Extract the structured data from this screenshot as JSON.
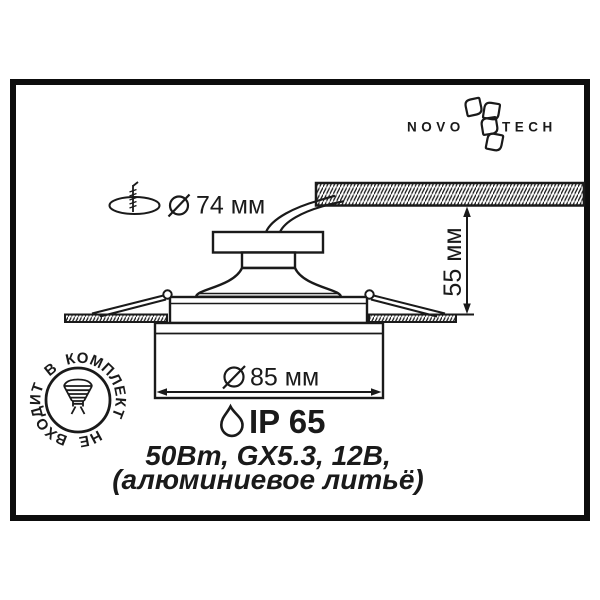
{
  "colors": {
    "ink": "#1a1a1a",
    "background": "#ffffff"
  },
  "brand": {
    "name_left": "NOVO",
    "name_right": "TECH",
    "flower_icon": "novotech-flower-icon"
  },
  "dimensions": {
    "cutout_diameter": {
      "icon": "screw-cutout-icon",
      "symbol": "diameter-symbol",
      "value": "74 мм"
    },
    "recess_depth": {
      "value": "55 мм"
    },
    "visible_diameter": {
      "symbol": "diameter-symbol",
      "value": "85 мм"
    }
  },
  "specs": {
    "ip_rating": {
      "icon": "water-drop-icon",
      "value": "IP 65"
    },
    "lamp_line": "50Вт, GX5.3, 12В,",
    "material_line": "(алюминиевое литьё)"
  },
  "stamp": {
    "icon": "mr16-lamp-icon",
    "text": "НЕ ВХОДИТ В КОМПЛЕКТ"
  }
}
